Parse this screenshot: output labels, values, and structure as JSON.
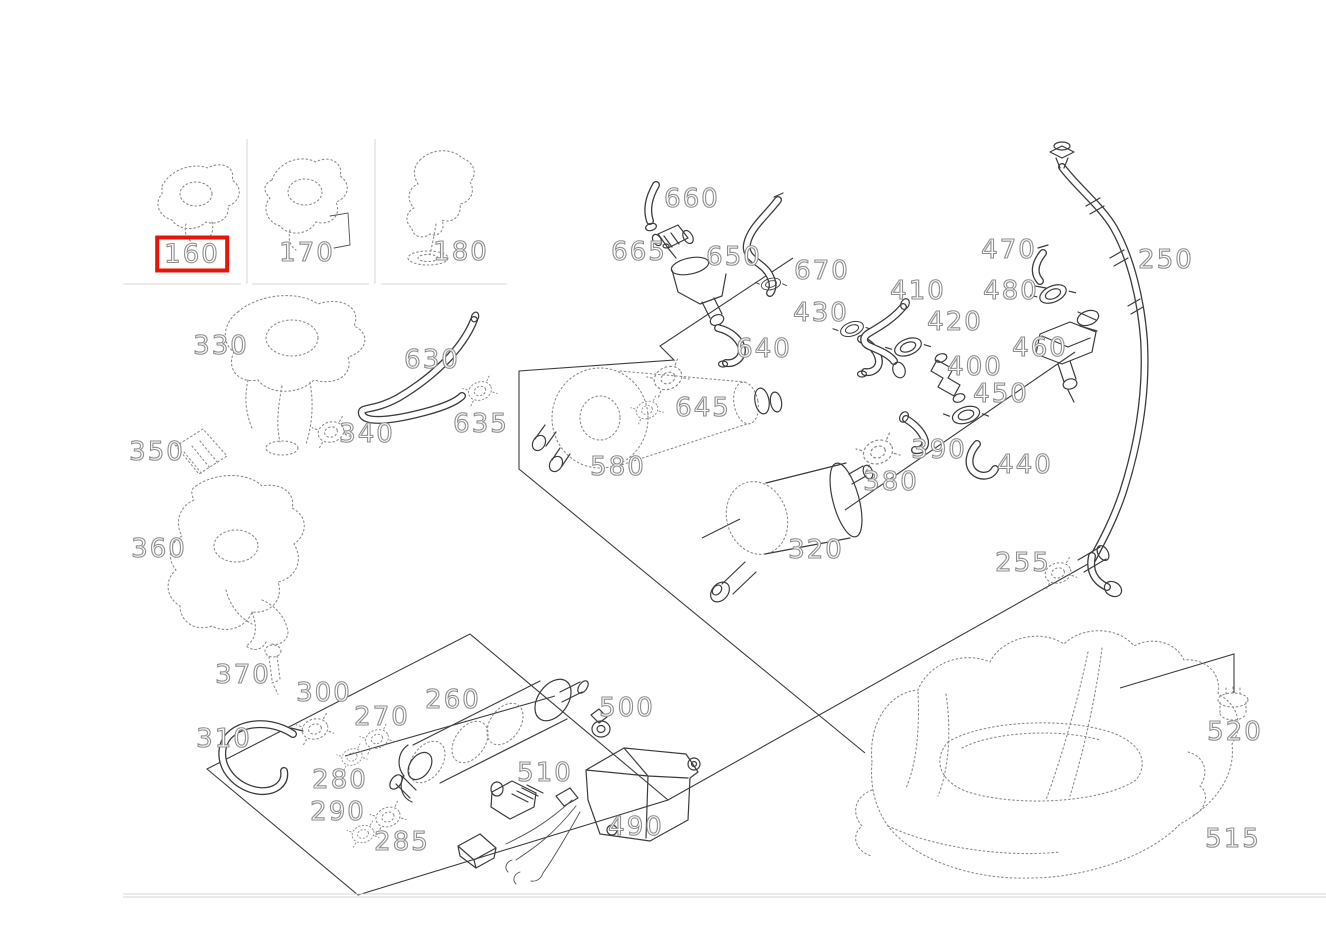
{
  "window": {
    "title": "Parts exploded diagram — fuel system",
    "background_color": "#ffffff"
  },
  "diagram": {
    "type": "exploded-parts-diagram",
    "line_color": "#3c3c3c",
    "reference_dot_color": "#8d8d8d",
    "label_outline_color": "#8f8f8f",
    "selected_part": "160",
    "selection_box_color": "#e8140c",
    "parts": [
      {
        "label": "160",
        "x": 192,
        "y": 254,
        "highlighted": true
      },
      {
        "label": "170",
        "x": 307,
        "y": 253,
        "highlighted": false
      },
      {
        "label": "180",
        "x": 461,
        "y": 252,
        "highlighted": false
      },
      {
        "label": "330",
        "x": 221,
        "y": 346,
        "highlighted": false
      },
      {
        "label": "340",
        "x": 367,
        "y": 434,
        "highlighted": false
      },
      {
        "label": "350",
        "x": 157,
        "y": 452,
        "highlighted": false
      },
      {
        "label": "360",
        "x": 159,
        "y": 549,
        "highlighted": false
      },
      {
        "label": "370",
        "x": 243,
        "y": 675,
        "highlighted": false
      },
      {
        "label": "630",
        "x": 432,
        "y": 360,
        "highlighted": false
      },
      {
        "label": "635",
        "x": 481,
        "y": 424,
        "highlighted": false
      },
      {
        "label": "580",
        "x": 618,
        "y": 467,
        "highlighted": false
      },
      {
        "label": "645",
        "x": 703,
        "y": 408,
        "highlighted": false
      },
      {
        "label": "640",
        "x": 764,
        "y": 349,
        "highlighted": false
      },
      {
        "label": "660",
        "x": 692,
        "y": 199,
        "highlighted": false
      },
      {
        "label": "665",
        "x": 639,
        "y": 252,
        "highlighted": false
      },
      {
        "label": "650",
        "x": 734,
        "y": 257,
        "highlighted": false
      },
      {
        "label": "670",
        "x": 822,
        "y": 271,
        "highlighted": false
      },
      {
        "label": "430",
        "x": 821,
        "y": 313,
        "highlighted": false
      },
      {
        "label": "410",
        "x": 918,
        "y": 291,
        "highlighted": false
      },
      {
        "label": "420",
        "x": 955,
        "y": 322,
        "highlighted": false
      },
      {
        "label": "400",
        "x": 975,
        "y": 367,
        "highlighted": false
      },
      {
        "label": "450",
        "x": 1001,
        "y": 394,
        "highlighted": false
      },
      {
        "label": "390",
        "x": 939,
        "y": 450,
        "highlighted": false
      },
      {
        "label": "380",
        "x": 891,
        "y": 482,
        "highlighted": false
      },
      {
        "label": "440",
        "x": 1025,
        "y": 465,
        "highlighted": false
      },
      {
        "label": "460",
        "x": 1040,
        "y": 348,
        "highlighted": false
      },
      {
        "label": "470",
        "x": 1009,
        "y": 250,
        "highlighted": false
      },
      {
        "label": "480",
        "x": 1011,
        "y": 291,
        "highlighted": false
      },
      {
        "label": "250",
        "x": 1166,
        "y": 260,
        "highlighted": false
      },
      {
        "label": "320",
        "x": 816,
        "y": 550,
        "highlighted": false
      },
      {
        "label": "255",
        "x": 1023,
        "y": 563,
        "highlighted": false
      },
      {
        "label": "300",
        "x": 324,
        "y": 693,
        "highlighted": false
      },
      {
        "label": "310",
        "x": 224,
        "y": 739,
        "highlighted": false
      },
      {
        "label": "270",
        "x": 382,
        "y": 717,
        "highlighted": false
      },
      {
        "label": "280",
        "x": 340,
        "y": 780,
        "highlighted": false
      },
      {
        "label": "290",
        "x": 338,
        "y": 812,
        "highlighted": false
      },
      {
        "label": "285",
        "x": 402,
        "y": 842,
        "highlighted": false
      },
      {
        "label": "260",
        "x": 453,
        "y": 700,
        "highlighted": false
      },
      {
        "label": "500",
        "x": 627,
        "y": 708,
        "highlighted": false
      },
      {
        "label": "510",
        "x": 545,
        "y": 773,
        "highlighted": false
      },
      {
        "label": "490",
        "x": 636,
        "y": 827,
        "highlighted": false
      },
      {
        "label": "520",
        "x": 1235,
        "y": 732,
        "highlighted": false
      },
      {
        "label": "515",
        "x": 1233,
        "y": 839,
        "highlighted": false
      }
    ]
  }
}
